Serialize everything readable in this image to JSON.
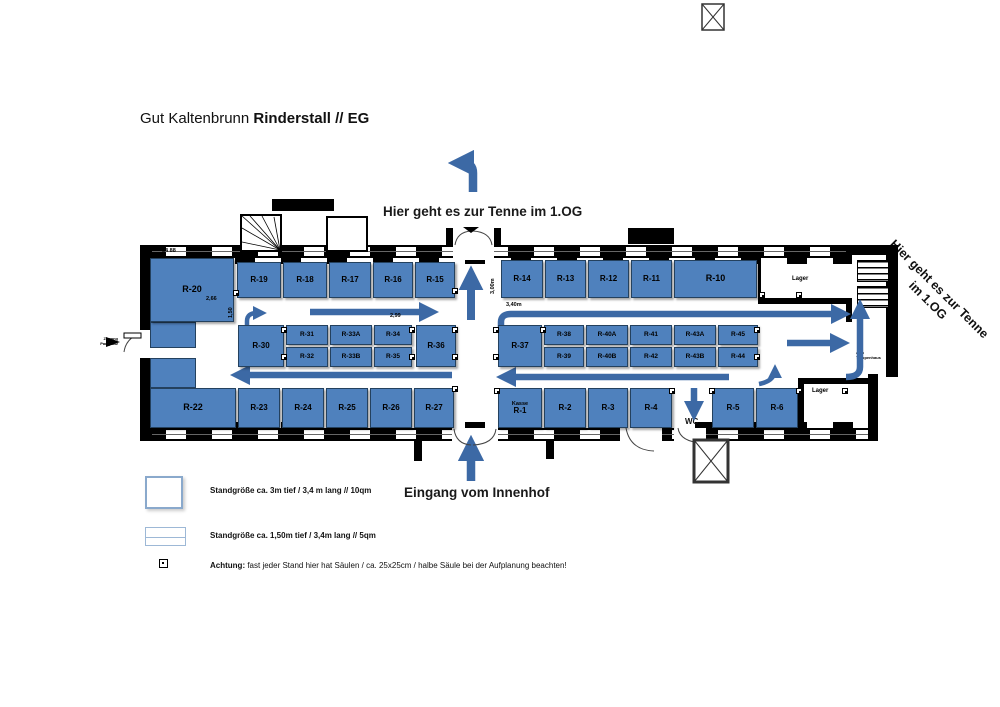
{
  "title": {
    "normal": "Gut Kaltenbrunn ",
    "bold": "Rinderstall // EG"
  },
  "directions": {
    "tenne_top": "Hier geht es zur Tenne im 1.OG",
    "tenne_right": "Hier geht es zur Tenne\nim 1.OG",
    "entrance": "Eingang vom Innenhof",
    "wc": "WC",
    "aufzug": "Aufzug",
    "zum_treppenhaus": "zum\nTreppenhaus",
    "zugang_parkplatz": "Zugang\nParkplatz"
  },
  "rooms": {
    "lager_top": "Lager",
    "lager_bottom": "Lager"
  },
  "legend": {
    "item1": "Standgröße ca. 3m tief / 3,4 m lang  // 10qm",
    "item2": "Standgröße ca. 1,50m tief / 3,4m lang // 5qm",
    "item3_bold": "Achtung:",
    "item3_rest": " fast jeder Stand hier hat Säulen / ca. 25x25cm / halbe Säule bei der Aufplanung beachten!"
  },
  "colors": {
    "stand": "#4f81bd",
    "stand_border": "#24415e",
    "arrow": "#3c69a5",
    "wall": "#000000"
  },
  "dimensions": [
    {
      "text": "2,66",
      "x": 206,
      "y": 296,
      "rot": 0
    },
    {
      "text": "1,50",
      "x": 228,
      "y": 318,
      "rot": -90
    },
    {
      "text": "2,99",
      "x": 390,
      "y": 313,
      "rot": 0
    },
    {
      "text": "3,00m",
      "x": 490,
      "y": 294,
      "rot": -90
    },
    {
      "text": "3,40m",
      "x": 506,
      "y": 302,
      "rot": 0
    },
    {
      "text": "84 88",
      "x": 162,
      "y": 248,
      "rot": 0
    },
    {
      "text": "88 81",
      "x": 380,
      "y": 429,
      "rot": 0
    }
  ],
  "stands": [
    {
      "id": "R-20",
      "x": 150,
      "y": 258,
      "w": 84,
      "h": 64
    },
    {
      "id": "R-19",
      "x": 237,
      "y": 262,
      "w": 44,
      "h": 36
    },
    {
      "id": "R-18",
      "x": 283,
      "y": 262,
      "w": 44,
      "h": 36
    },
    {
      "id": "R-17",
      "x": 329,
      "y": 262,
      "w": 42,
      "h": 36
    },
    {
      "id": "R-16",
      "x": 373,
      "y": 262,
      "w": 40,
      "h": 36
    },
    {
      "id": "R-15",
      "x": 415,
      "y": 262,
      "w": 40,
      "h": 36
    },
    {
      "id": "R-14",
      "x": 501,
      "y": 260,
      "w": 42,
      "h": 38
    },
    {
      "id": "R-13",
      "x": 545,
      "y": 260,
      "w": 41,
      "h": 38
    },
    {
      "id": "R-12",
      "x": 588,
      "y": 260,
      "w": 41,
      "h": 38
    },
    {
      "id": "R-11",
      "x": 631,
      "y": 260,
      "w": 41,
      "h": 38
    },
    {
      "id": "R-10",
      "x": 674,
      "y": 260,
      "w": 83,
      "h": 38
    },
    {
      "id": "R-30",
      "x": 238,
      "y": 325,
      "w": 46,
      "h": 42
    },
    {
      "id": "R-31",
      "x": 286,
      "y": 325,
      "w": 42,
      "h": 20
    },
    {
      "id": "R-32",
      "x": 286,
      "y": 347,
      "w": 42,
      "h": 20
    },
    {
      "id": "R-33A",
      "x": 330,
      "y": 325,
      "w": 42,
      "h": 20
    },
    {
      "id": "R-33B",
      "x": 330,
      "y": 347,
      "w": 42,
      "h": 20
    },
    {
      "id": "R-34",
      "x": 374,
      "y": 325,
      "w": 38,
      "h": 20
    },
    {
      "id": "R-35",
      "x": 374,
      "y": 347,
      "w": 38,
      "h": 20
    },
    {
      "id": "R-36",
      "x": 416,
      "y": 325,
      "w": 40,
      "h": 42
    },
    {
      "id": "R-37",
      "x": 498,
      "y": 325,
      "w": 44,
      "h": 42
    },
    {
      "id": "R-38",
      "x": 544,
      "y": 325,
      "w": 40,
      "h": 20
    },
    {
      "id": "R-39",
      "x": 544,
      "y": 347,
      "w": 40,
      "h": 20
    },
    {
      "id": "R-40A",
      "x": 586,
      "y": 325,
      "w": 42,
      "h": 20
    },
    {
      "id": "R-40B",
      "x": 586,
      "y": 347,
      "w": 42,
      "h": 20
    },
    {
      "id": "R-41",
      "x": 630,
      "y": 325,
      "w": 42,
      "h": 20
    },
    {
      "id": "R-42",
      "x": 630,
      "y": 347,
      "w": 42,
      "h": 20
    },
    {
      "id": "R-43A",
      "x": 674,
      "y": 325,
      "w": 42,
      "h": 20
    },
    {
      "id": "R-43B",
      "x": 674,
      "y": 347,
      "w": 42,
      "h": 20
    },
    {
      "id": "R-45",
      "x": 718,
      "y": 325,
      "w": 40,
      "h": 20
    },
    {
      "id": "R-44",
      "x": 718,
      "y": 347,
      "w": 40,
      "h": 20
    },
    {
      "id": "R-22",
      "x": 150,
      "y": 388,
      "w": 86,
      "h": 40
    },
    {
      "id": "R-23",
      "x": 238,
      "y": 388,
      "w": 42,
      "h": 40
    },
    {
      "id": "R-24",
      "x": 282,
      "y": 388,
      "w": 42,
      "h": 40
    },
    {
      "id": "R-25",
      "x": 326,
      "y": 388,
      "w": 42,
      "h": 40
    },
    {
      "id": "R-26",
      "x": 370,
      "y": 388,
      "w": 42,
      "h": 40
    },
    {
      "id": "R-27",
      "x": 414,
      "y": 388,
      "w": 40,
      "h": 40
    },
    {
      "id": "R-1",
      "pre": "Kasse",
      "x": 498,
      "y": 388,
      "w": 44,
      "h": 40
    },
    {
      "id": "R-2",
      "x": 544,
      "y": 388,
      "w": 42,
      "h": 40
    },
    {
      "id": "R-3",
      "x": 588,
      "y": 388,
      "w": 40,
      "h": 40
    },
    {
      "id": "R-4",
      "x": 630,
      "y": 388,
      "w": 42,
      "h": 40
    },
    {
      "id": "R-5",
      "x": 712,
      "y": 388,
      "w": 42,
      "h": 40
    },
    {
      "id": "R-6",
      "x": 756,
      "y": 388,
      "w": 42,
      "h": 40
    }
  ],
  "patches": [
    [
      150,
      322,
      46,
      26
    ],
    [
      150,
      358,
      46,
      30
    ]
  ],
  "columns": [
    [
      233,
      290
    ],
    [
      452,
      288
    ],
    [
      452,
      386
    ],
    [
      281,
      327
    ],
    [
      281,
      354
    ],
    [
      409,
      327
    ],
    [
      409,
      354
    ],
    [
      452,
      327
    ],
    [
      452,
      354
    ],
    [
      493,
      327
    ],
    [
      493,
      354
    ],
    [
      540,
      327
    ],
    [
      754,
      327
    ],
    [
      754,
      354
    ],
    [
      494,
      388
    ],
    [
      669,
      388
    ],
    [
      709,
      388
    ],
    [
      796,
      388
    ],
    [
      759,
      292
    ],
    [
      796,
      292
    ],
    [
      842,
      388
    ]
  ]
}
